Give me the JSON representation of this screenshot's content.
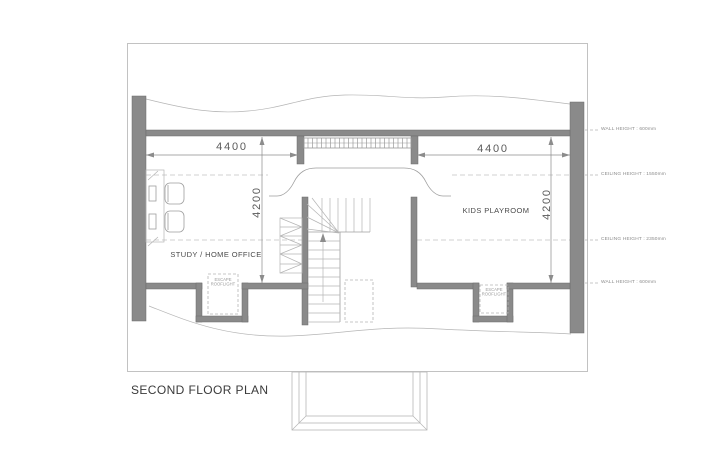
{
  "sheet": {
    "title": "SECOND FLOOR PLAN"
  },
  "rooms": {
    "study": {
      "label": "STUDY / HOME OFFICE"
    },
    "playroom": {
      "label": "KIDS PLAYROOM"
    }
  },
  "dimensions": {
    "study_width": "4400",
    "playroom_width": "4400",
    "study_depth": "4200",
    "playroom_depth": "4200"
  },
  "skylights": {
    "left": {
      "line1": "ESCAPE",
      "line2": "ROOFLIGHT"
    },
    "right": {
      "line1": "ESCAPE",
      "line2": "ROOFLIGHT"
    }
  },
  "annotations": {
    "top_wall": "WALL HEIGHT : 600mm",
    "upper_ceiling": "CEILING HEIGHT : 1550mm",
    "lower_ceiling": "CEILING HEIGHT : 2350mm",
    "bottom_wall": "WALL HEIGHT : 600mm"
  },
  "colors": {
    "wall": "#8a8a8a",
    "line": "#9f9f9f",
    "dash": "#c4c4c4",
    "text": "#3c3c3c"
  }
}
